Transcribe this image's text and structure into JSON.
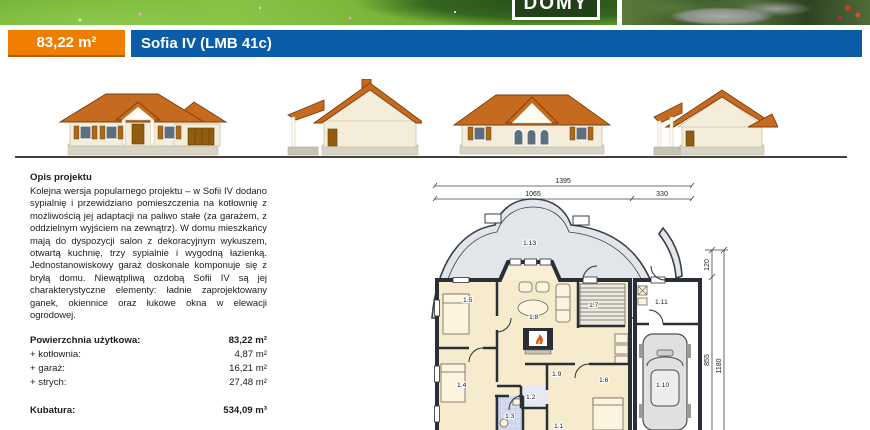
{
  "header": {
    "logo_text": "DOMY",
    "area_badge": "83,22 m²",
    "title": "Sofia IV (LMB 41c)"
  },
  "colors": {
    "accent_orange": "#ee7d00",
    "accent_blue": "#0b5ca8",
    "roof": "#c56a1e"
  },
  "description": {
    "heading": "Opis projektu",
    "body": "Kolejna wersja popularnego projektu – w Sofii IV dodano sypialnię i przewidziano pomieszczenia na kotłownię z możliwością jej adaptacji na paliwo stałe (za garażem, z oddzielnym wyjściem na zewnątrz). W domu mieszkańcy mają do dyspozycji salon z dekoracyjnym wykuszem, otwartą kuchnię, trzy sypialnie i wygodną łazienką. Jednostanowiskowy garaż doskonale komponuje się z bryłą domu. Niewątpliwą ozdobą Sofii IV są jej charakterystyczne elementy: ładnie zaprojektowany ganek, okiennice oraz łukowe okna w elewacji ogrodowej."
  },
  "areas": {
    "rows": [
      {
        "label": "Powierzchnia użytkowa:",
        "value": "83,22 m²"
      },
      {
        "label": "+ kotłownia:",
        "value": "4,87 m²"
      },
      {
        "label": "+ garaż:",
        "value": "16,21 m²"
      },
      {
        "label": "+ strych:",
        "value": "27,48 m²"
      }
    ],
    "kubatura_label": "Kubatura:",
    "kubatura_value": "534,09 m³"
  },
  "floor_plan": {
    "dims": {
      "total_width": "1395",
      "main_width": "1065",
      "garage_width": "330",
      "depth_porch": "120",
      "depth_main": "855",
      "depth_total": "1180"
    },
    "rooms": {
      "r1": "1.1",
      "r2": "1.2",
      "r3": "1.3",
      "r4": "1.4",
      "r5": "1.5",
      "r6": "1.6",
      "r7": "1.7",
      "r8": "1.8",
      "r9": "1.9",
      "r10": "1.10",
      "r11": "1.11",
      "r13": "1.13"
    }
  }
}
